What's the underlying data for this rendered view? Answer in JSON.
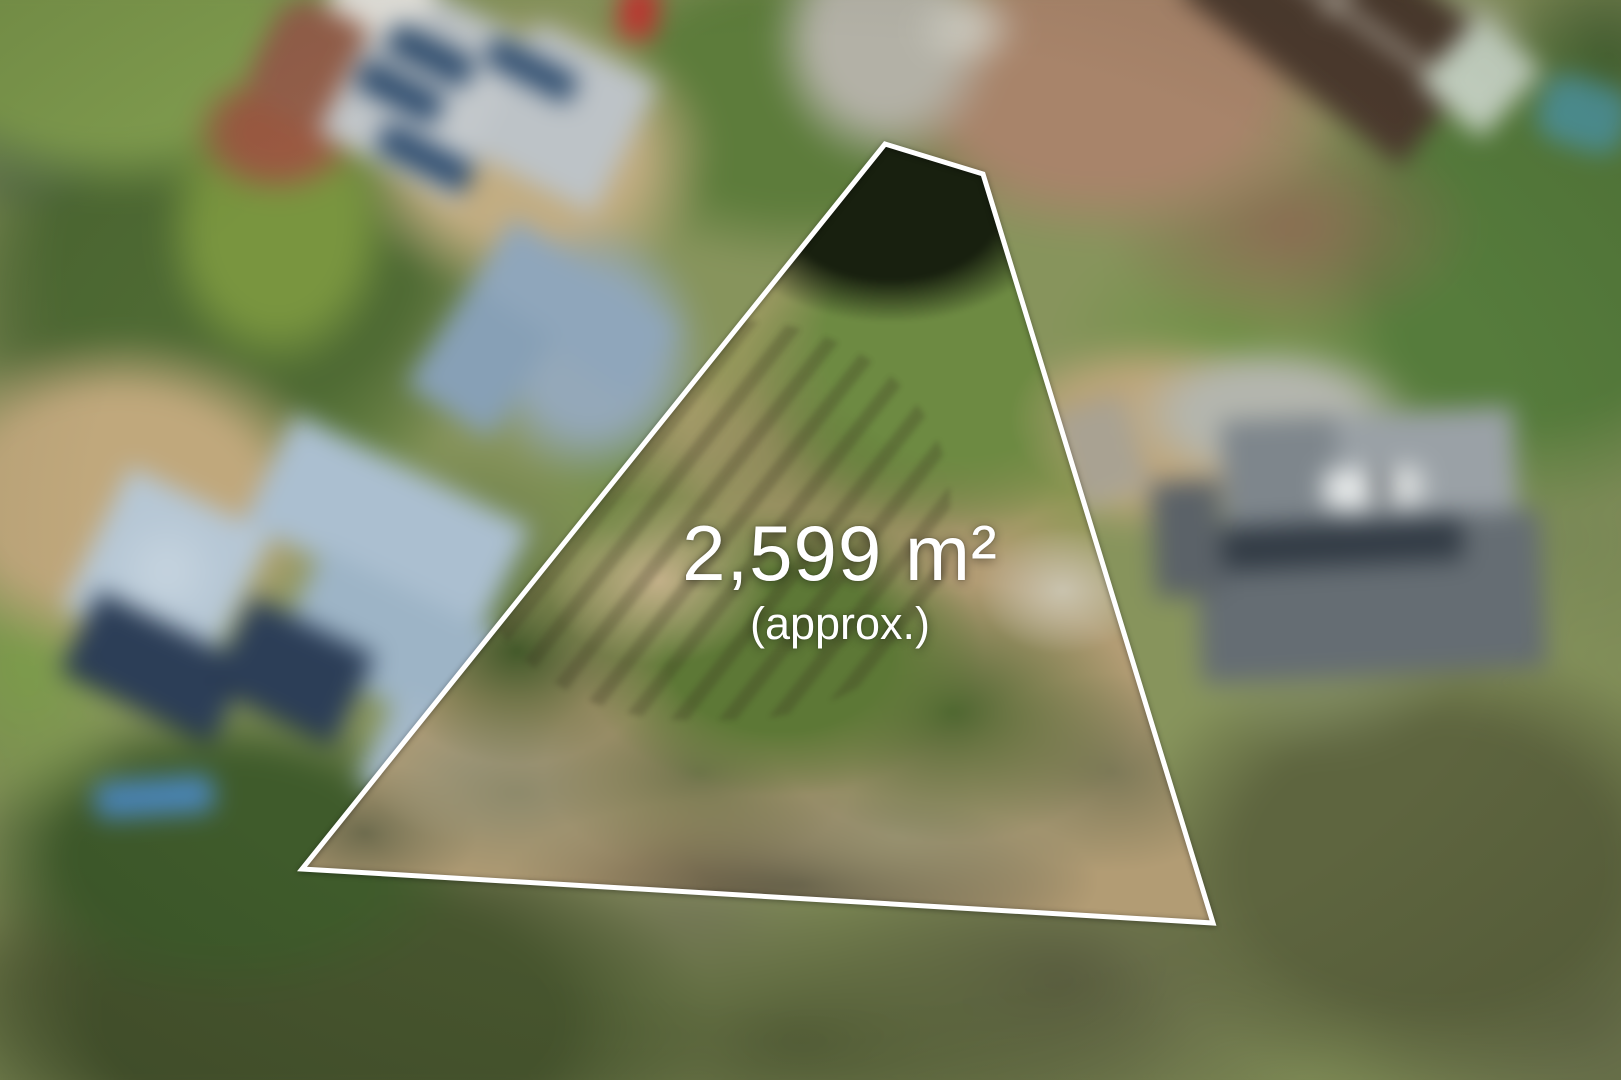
{
  "overlay": {
    "area_label": "2,599 m²",
    "approx_label": "(approx.)",
    "text_color": "#ffffff"
  },
  "lot": {
    "points_attr": "885,144 983,174 1213,923 302,869",
    "clip_path": "polygon(885px 144px, 983px 174px, 1213px 923px, 302px 869px)",
    "stroke_color": "#ffffff",
    "stroke_width_px": 5
  },
  "scene": {
    "description_colors": {
      "boundary_line": "#ffffff",
      "lot_dirt": "#b29c74",
      "lot_canopy_green": "#6d8a42",
      "surround_green": "#4e6a33",
      "roof_grey_topleft": "#c3c8cb",
      "roof_bluegrey_midleft": "#8fa6bb",
      "roof_paleblue_lowerleft": "#abbfd0",
      "roof_dark_right": "#656d73",
      "roof_brown_topright": "#4c3a2e",
      "solar_panel": "#2b4a6d",
      "paver_drive": "#a8846a",
      "road_grey": "#b3b1a6",
      "pool_blue": "#4a86b8",
      "car_red": "#bf3631",
      "car_white": "#e6e9e9"
    }
  }
}
